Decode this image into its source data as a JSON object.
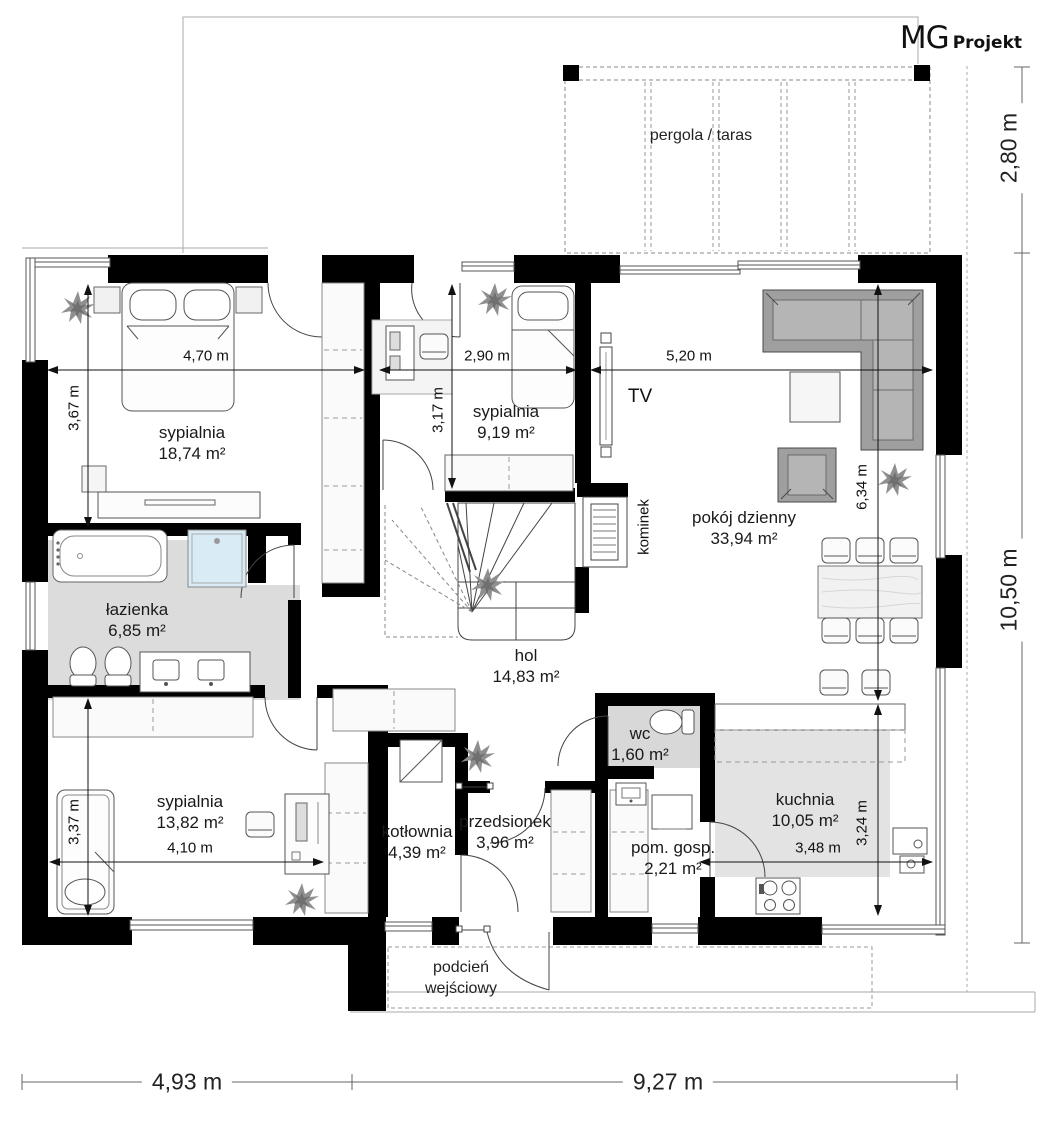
{
  "logo": {
    "mg": "MG",
    "projekt": "Projekt"
  },
  "labels": {
    "pergola": "pergola / taras",
    "tv": "TV",
    "kominek": "kominek",
    "podcien_line1": "podcień",
    "podcien_line2": "wejściowy"
  },
  "rooms": [
    {
      "name": "sypialnia",
      "area": "18,74 m²"
    },
    {
      "name": "sypialnia",
      "area": "9,19 m²"
    },
    {
      "name": "pokój dzienny",
      "area": "33,94 m²"
    },
    {
      "name": "łazienka",
      "area": "6,85 m²"
    },
    {
      "name": "hol",
      "area": "14,83 m²"
    },
    {
      "name": "sypialnia",
      "area": "13,82 m²"
    },
    {
      "name": "kotłownia",
      "area": "4,39 m²"
    },
    {
      "name": "przedsionek",
      "area": "3,96 m²"
    },
    {
      "name": "wc",
      "area": "1,60 m²"
    },
    {
      "name": "pom. gosp.",
      "area": "2,21 m²"
    },
    {
      "name": "kuchnia",
      "area": "10,05 m²"
    }
  ],
  "dimensions": {
    "bedroom1_width": "4,70 m",
    "bedroom1_height": "3,67 m",
    "bedroom2_width": "2,90 m",
    "bedroom2_height": "3,17 m",
    "living_width": "5,20 m",
    "living_height": "6,34 m",
    "bedroom3_width": "4,10 m",
    "bedroom3_height": "3,37 m",
    "kitchen_width": "3,48 m",
    "kitchen_height": "3,24 m",
    "pergola_depth": "2,80 m",
    "house_depth": "10,50 m",
    "house_width_left": "4,93 m",
    "house_width_right": "9,27 m"
  },
  "colors": {
    "wall": "#000000",
    "bath_floor": "#dcdcdc",
    "kitchen_floor": "#e3e3e3",
    "shower": "#d9ecf6",
    "sofa": "#9f9f9f",
    "line": "#444444"
  }
}
